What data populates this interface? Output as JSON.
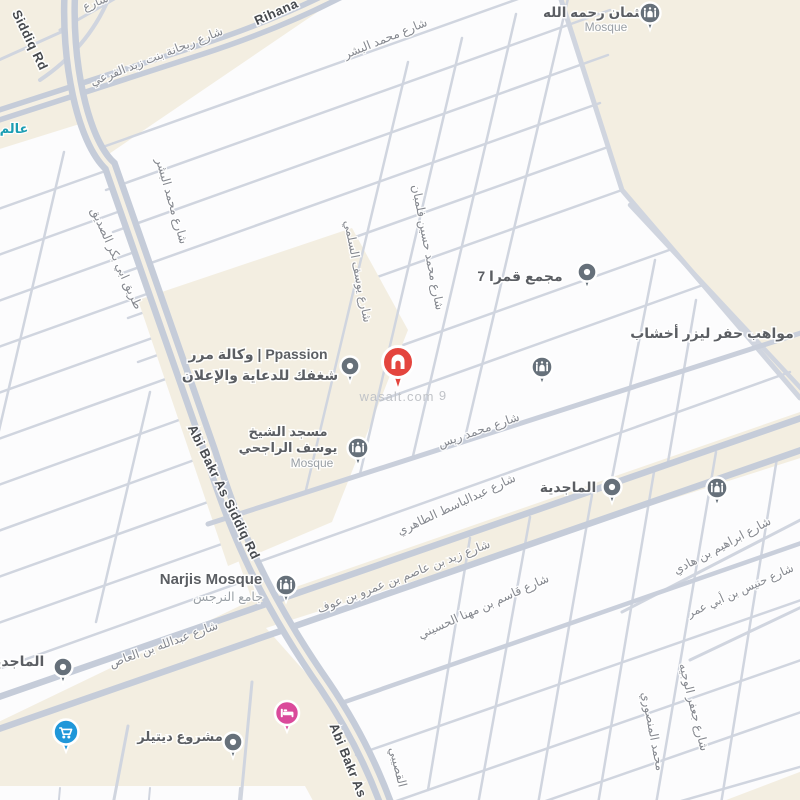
{
  "map": {
    "watermark": "wasalt.com",
    "watermark2": "9",
    "colors": {
      "background_cream": "#f3eee1",
      "block_white": "#fcfcfd",
      "road_minor": "#d0d5df",
      "road_major": "#c5ccd9",
      "street_label": "#85888f",
      "road_label_dark": "#46494e",
      "poi_label": "#5b5e63",
      "poi_sublabel": "#9aa0a6",
      "teal_poi": "#1a9db3",
      "wasalt_red": "#e4453e",
      "pin_slate": "#66707a",
      "pin_blue": "#1f97d9",
      "pin_pink": "#da4a9b"
    },
    "icons": {
      "wasalt_pin": "home-pin",
      "mosque_pin": "mosque-dome",
      "dot_pin": "poi-dot",
      "cart_pin": "shopping-cart",
      "bed_pin": "hotel-bed"
    },
    "labels": {
      "rihana_ar": "شارع ريحانة بنت زيد الفرعي",
      "rihana_en": "Rihana",
      "sharia_partial": "شارع",
      "alam_partial": "عالم",
      "siddiq_rd_top": "Siddiq Rd",
      "tariq_abibakr_ar": "طريق ابي بكر الصديق",
      "abibakr_rd_mid": "Abi Bakr As Siddiq Rd",
      "abibakr_bottom": "Abi Bakr As",
      "bishr_h": "شارع محمد البشر",
      "bishr_v": "شارع محمد البشر",
      "falamban": "شارع محمد حسين فلمبان",
      "sulami": "شارع يوسف السلمي",
      "reis": "شارع محمد ريس",
      "abdulbasit": "شارع عبدالباسط الطاهري",
      "zayd_asim": "شارع زيد بن عاصم بن عمرو بن عوف",
      "qasim": "شارع قاسم بن مهنا الحسيني",
      "ibrahim_hadi": "شارع ابراهيم بن هادي",
      "hunais_omar": "شارع حنيس بن أبي عمر",
      "jaafar_wajih": "شارع جعفر الوجيه",
      "mansouri": "محمد المنصوري",
      "qusaibi": "القصيبي",
      "abdullah_aas": "شارع عبدالله بن العاص"
    },
    "pois": {
      "othman": {
        "line1": "العثمان رحمه الله",
        "line2": "Mosque"
      },
      "qamra": {
        "name": "مجمع قمرا 7"
      },
      "mawaheb": {
        "name": "مواهب حفر ليزر أخشاب"
      },
      "ppassion": {
        "line1": "وكالة مرر | Ppassion",
        "line2": "شغفك للدعاية والإعلان"
      },
      "rajhi": {
        "line1": "مسجد الشيخ",
        "line2": "يوسف الراجحي",
        "line3": "Mosque"
      },
      "majdiyah": {
        "name": "الماجدية"
      },
      "narjis": {
        "line1": "Narjis Mosque",
        "line2": "جامع النرجس"
      },
      "majdiyah_left": {
        "name": "الماجدية"
      },
      "detailer": {
        "name": "مشروع ديتيلر"
      }
    }
  }
}
